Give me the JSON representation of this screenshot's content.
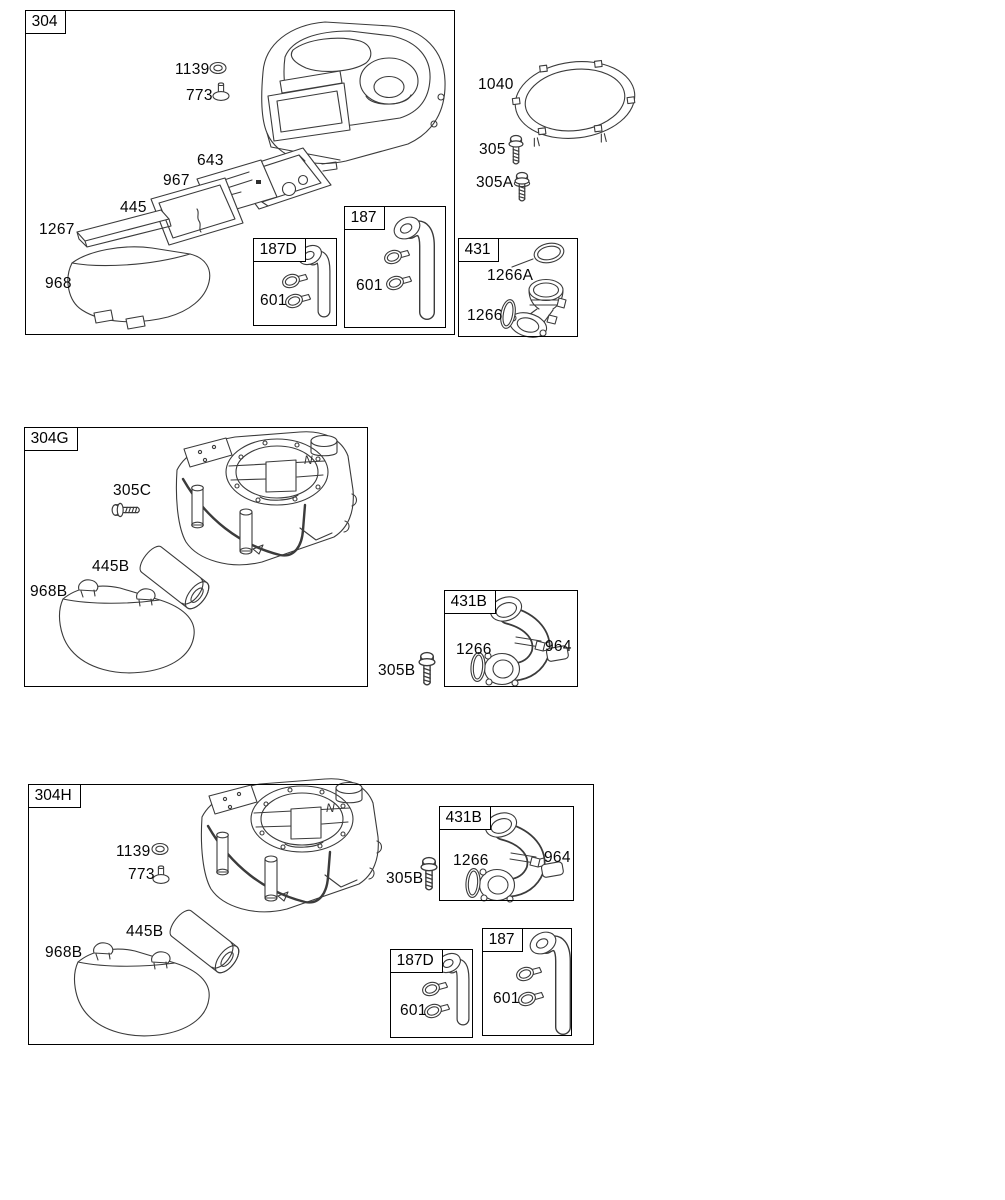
{
  "panels": {
    "p304": "304",
    "p187d_top": "187D",
    "p187_top": "187",
    "p431": "431",
    "p304g": "304G",
    "p431b_mid": "431B",
    "p304h": "304H",
    "p431b_bot": "431B",
    "p187d_bot": "187D",
    "p187_bot": "187"
  },
  "callouts": {
    "top": {
      "c1139": "1139",
      "c773": "773",
      "c643": "643",
      "c967": "967",
      "c445": "445",
      "c1267": "1267",
      "c968": "968",
      "c601_187d": "601",
      "c601_187": "601",
      "c1040": "1040",
      "c305": "305",
      "c305a": "305A",
      "c1266a": "1266A",
      "c1266": "1266"
    },
    "mid": {
      "c305c": "305C",
      "c445b": "445B",
      "c968b": "968B",
      "c305b": "305B",
      "c1266": "1266",
      "c964": "964"
    },
    "bot": {
      "c1139": "1139",
      "c773": "773",
      "c445b": "445B",
      "c968b": "968B",
      "c305b": "305B",
      "c1266": "1266",
      "c964": "964",
      "c601_187d": "601",
      "c601_187": "601"
    }
  },
  "marks": {
    "n": "N"
  }
}
